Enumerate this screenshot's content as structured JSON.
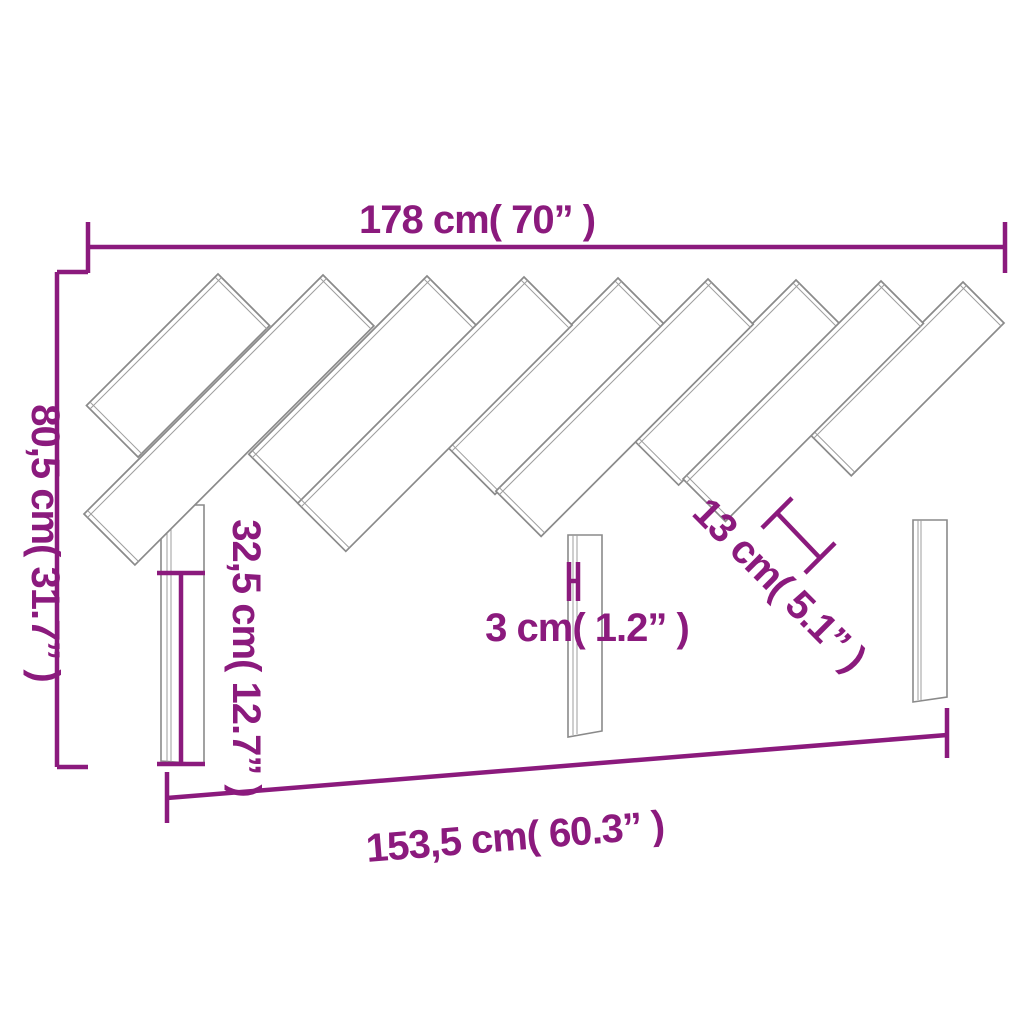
{
  "diagram": {
    "type": "product-dimension-diagram",
    "product": "slatted-headboard-with-three-legs",
    "slat_count": 9,
    "leg_count": 3
  },
  "colors": {
    "dimension": "#8b1a7d",
    "outline": "#8a8a8a",
    "detail": "#9e9e9e",
    "background": "#ffffff"
  },
  "dimensions": {
    "total_width": {
      "cm": "178",
      "inch": "70",
      "label": "178 cm( 70”  )"
    },
    "total_height": {
      "cm": "80,5",
      "inch": "31.7",
      "label": "80,5 cm( 31.7”  )"
    },
    "leg_height": {
      "cm": "32,5",
      "inch": "12.7",
      "label": "32,5 cm( 12.7”  )"
    },
    "board_thickness": {
      "cm": "3",
      "inch": "1.2",
      "label": "3 cm( 1.2”  )"
    },
    "slat_width": {
      "cm": "13",
      "inch": "5.1",
      "label": "13 cm( 5.1”  )"
    },
    "legs_span_width": {
      "cm": "153,5",
      "inch": "60.3",
      "label": "153,5 cm( 60.3”  )"
    }
  }
}
